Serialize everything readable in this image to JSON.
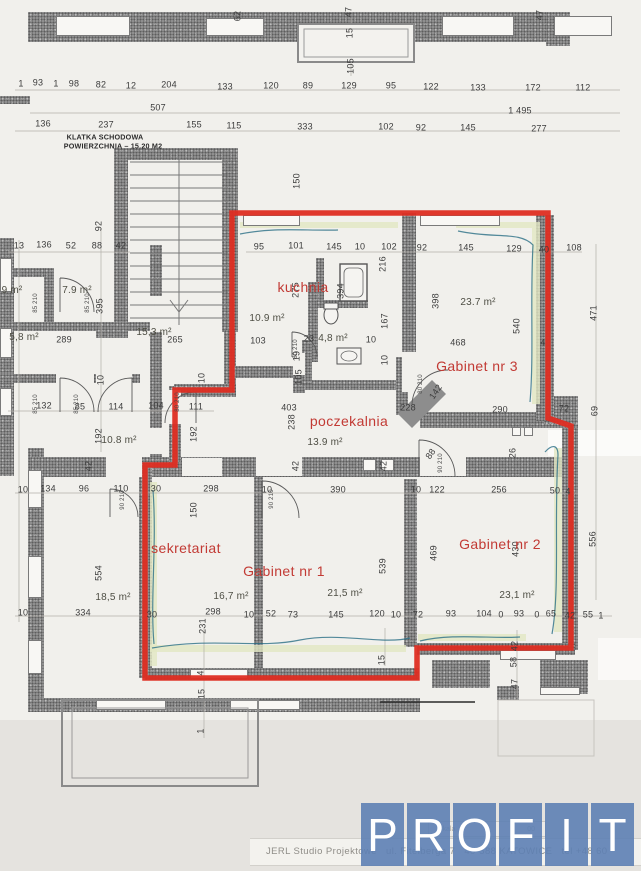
{
  "stairwell_note": {
    "line1": "KLATKA SCHODOWA",
    "line2": "POWIERZCHNIA – 15.20 M2"
  },
  "rooms": [
    {
      "label": "kuchnia",
      "x": 303,
      "y": 287,
      "area": "10.9 m²",
      "ax": 267,
      "ay": 319
    },
    {
      "label": "Gabinet nr 3",
      "x": 477,
      "y": 366,
      "area": "23.7 m²",
      "ax": 478,
      "ay": 303
    },
    {
      "label": "poczekalnia",
      "x": 349,
      "y": 421,
      "area": "13.9 m²",
      "ax": 325,
      "ay": 443
    },
    {
      "label": "sekretariat",
      "x": 186,
      "y": 548,
      "area": "16,7 m²",
      "ax": 231,
      "ay": 597
    },
    {
      "label": "Gabinet nr 1",
      "x": 284,
      "y": 571,
      "area": "21,5 m²",
      "ax": 345,
      "ay": 594
    },
    {
      "label": "Gabinet nr 2",
      "x": 500,
      "y": 544,
      "area": "23,1 m²",
      "ax": 517,
      "ay": 596
    },
    {
      "label": "",
      "x": 0,
      "y": 0,
      "area": "4,8 m²",
      "ax": 333,
      "ay": 339
    }
  ],
  "outside_areas": [
    {
      "area": "9 m²",
      "x": 12,
      "y": 291
    },
    {
      "area": "7.9 m²",
      "x": 77,
      "y": 291
    },
    {
      "area": "5,8 m²",
      "x": 24,
      "y": 338
    },
    {
      "area": "15,3 m²",
      "x": 154,
      "y": 333
    },
    {
      "area": "10.8 m²",
      "x": 119,
      "y": 441
    },
    {
      "area": "18,5 m²",
      "x": 113,
      "y": 598
    }
  ],
  "dimensions": [
    {
      "t": "62",
      "x": 238,
      "y": 16,
      "o": "v"
    },
    {
      "t": "47",
      "x": 349,
      "y": 12,
      "o": "v"
    },
    {
      "t": "15",
      "x": 350,
      "y": 33,
      "o": "v"
    },
    {
      "t": "105",
      "x": 351,
      "y": 66,
      "o": "v"
    },
    {
      "t": "47",
      "x": 540,
      "y": 15,
      "o": "v"
    },
    {
      "t": "1",
      "x": 21,
      "y": 84
    },
    {
      "t": "93",
      "x": 38,
      "y": 83
    },
    {
      "t": "1",
      "x": 56,
      "y": 84
    },
    {
      "t": "98",
      "x": 74,
      "y": 84
    },
    {
      "t": "82",
      "x": 101,
      "y": 85
    },
    {
      "t": "12",
      "x": 131,
      "y": 86
    },
    {
      "t": "204",
      "x": 169,
      "y": 85
    },
    {
      "t": "133",
      "x": 225,
      "y": 87
    },
    {
      "t": "120",
      "x": 271,
      "y": 86
    },
    {
      "t": "89",
      "x": 308,
      "y": 86
    },
    {
      "t": "129",
      "x": 349,
      "y": 86
    },
    {
      "t": "95",
      "x": 391,
      "y": 86
    },
    {
      "t": "122",
      "x": 431,
      "y": 87
    },
    {
      "t": "133",
      "x": 478,
      "y": 88
    },
    {
      "t": "172",
      "x": 533,
      "y": 88
    },
    {
      "t": "112",
      "x": 583,
      "y": 88
    },
    {
      "t": "507",
      "x": 158,
      "y": 108
    },
    {
      "t": "1 495",
      "x": 520,
      "y": 111
    },
    {
      "t": "136",
      "x": 43,
      "y": 124
    },
    {
      "t": "237",
      "x": 106,
      "y": 125
    },
    {
      "t": "155",
      "x": 194,
      "y": 125
    },
    {
      "t": "115",
      "x": 234,
      "y": 126
    },
    {
      "t": "333",
      "x": 305,
      "y": 127
    },
    {
      "t": "102",
      "x": 386,
      "y": 127
    },
    {
      "t": "92",
      "x": 421,
      "y": 128
    },
    {
      "t": "145",
      "x": 468,
      "y": 128
    },
    {
      "t": "277",
      "x": 539,
      "y": 129
    },
    {
      "t": "150",
      "x": 297,
      "y": 181,
      "o": "v"
    },
    {
      "t": "92",
      "x": 99,
      "y": 226,
      "o": "v"
    },
    {
      "t": "13",
      "x": 19,
      "y": 246
    },
    {
      "t": "136",
      "x": 44,
      "y": 245
    },
    {
      "t": "52",
      "x": 71,
      "y": 246
    },
    {
      "t": "88",
      "x": 97,
      "y": 246
    },
    {
      "t": "42",
      "x": 121,
      "y": 246
    },
    {
      "t": "395",
      "x": 100,
      "y": 306,
      "o": "v"
    },
    {
      "t": "289",
      "x": 64,
      "y": 340
    },
    {
      "t": "265",
      "x": 175,
      "y": 340
    },
    {
      "t": "10",
      "x": 101,
      "y": 380,
      "o": "v"
    },
    {
      "t": "10",
      "x": 202,
      "y": 378,
      "o": "v"
    },
    {
      "t": "132",
      "x": 44,
      "y": 406
    },
    {
      "t": "85",
      "x": 80,
      "y": 407
    },
    {
      "t": "114",
      "x": 116,
      "y": 407
    },
    {
      "t": "104",
      "x": 156,
      "y": 406
    },
    {
      "t": "111",
      "x": 196,
      "y": 407
    },
    {
      "t": "192",
      "x": 99,
      "y": 436,
      "o": "v"
    },
    {
      "t": "192",
      "x": 194,
      "y": 434,
      "o": "v"
    },
    {
      "t": "42",
      "x": 89,
      "y": 466,
      "o": "v"
    },
    {
      "t": "42",
      "x": 296,
      "y": 466,
      "o": "v"
    },
    {
      "t": "42",
      "x": 384,
      "y": 466,
      "o": "v"
    },
    {
      "t": "403",
      "x": 289,
      "y": 408
    },
    {
      "t": "238",
      "x": 292,
      "y": 422,
      "o": "v"
    },
    {
      "t": "228",
      "x": 408,
      "y": 408
    },
    {
      "t": "142",
      "x": 436,
      "y": 392,
      "o": "d"
    },
    {
      "t": "88",
      "x": 431,
      "y": 454,
      "o": "d"
    },
    {
      "t": "95",
      "x": 259,
      "y": 247
    },
    {
      "t": "101",
      "x": 296,
      "y": 246
    },
    {
      "t": "145",
      "x": 334,
      "y": 247
    },
    {
      "t": "10",
      "x": 360,
      "y": 247
    },
    {
      "t": "102",
      "x": 389,
      "y": 247
    },
    {
      "t": "92",
      "x": 422,
      "y": 248
    },
    {
      "t": "145",
      "x": 466,
      "y": 248
    },
    {
      "t": "129",
      "x": 514,
      "y": 249
    },
    {
      "t": "40",
      "x": 544,
      "y": 250
    },
    {
      "t": "108",
      "x": 574,
      "y": 248
    },
    {
      "t": "275",
      "x": 296,
      "y": 290,
      "o": "v"
    },
    {
      "t": "394",
      "x": 341,
      "y": 291,
      "o": "v"
    },
    {
      "t": "216",
      "x": 383,
      "y": 264,
      "o": "v"
    },
    {
      "t": "103",
      "x": 258,
      "y": 341
    },
    {
      "t": "23",
      "x": 309,
      "y": 339
    },
    {
      "t": "10",
      "x": 371,
      "y": 340
    },
    {
      "t": "167",
      "x": 385,
      "y": 321,
      "o": "v"
    },
    {
      "t": "10",
      "x": 385,
      "y": 360,
      "o": "v"
    },
    {
      "t": "19",
      "x": 297,
      "y": 356,
      "o": "v"
    },
    {
      "t": "105",
      "x": 299,
      "y": 377,
      "o": "v"
    },
    {
      "t": "398",
      "x": 436,
      "y": 301,
      "o": "v"
    },
    {
      "t": "540",
      "x": 517,
      "y": 326,
      "o": "v"
    },
    {
      "t": "468",
      "x": 458,
      "y": 343
    },
    {
      "t": "4",
      "x": 543,
      "y": 343
    },
    {
      "t": "290",
      "x": 500,
      "y": 410
    },
    {
      "t": "72",
      "x": 564,
      "y": 409
    },
    {
      "t": "69",
      "x": 595,
      "y": 411,
      "o": "v"
    },
    {
      "t": "471",
      "x": 594,
      "y": 313,
      "o": "v"
    },
    {
      "t": "10",
      "x": 23,
      "y": 490
    },
    {
      "t": "134",
      "x": 48,
      "y": 489
    },
    {
      "t": "96",
      "x": 84,
      "y": 489
    },
    {
      "t": "110",
      "x": 121,
      "y": 489
    },
    {
      "t": "30",
      "x": 156,
      "y": 489
    },
    {
      "t": "298",
      "x": 211,
      "y": 489
    },
    {
      "t": "10",
      "x": 267,
      "y": 490
    },
    {
      "t": "390",
      "x": 338,
      "y": 490
    },
    {
      "t": "10",
      "x": 416,
      "y": 490
    },
    {
      "t": "122",
      "x": 437,
      "y": 490
    },
    {
      "t": "256",
      "x": 499,
      "y": 490
    },
    {
      "t": "50",
      "x": 555,
      "y": 491
    },
    {
      "t": "4",
      "x": 568,
      "y": 492
    },
    {
      "t": "150",
      "x": 194,
      "y": 510,
      "o": "v"
    },
    {
      "t": "539",
      "x": 383,
      "y": 566,
      "o": "v"
    },
    {
      "t": "556",
      "x": 593,
      "y": 539,
      "o": "v"
    },
    {
      "t": "469",
      "x": 434,
      "y": 553,
      "o": "v"
    },
    {
      "t": "430",
      "x": 516,
      "y": 549,
      "o": "v"
    },
    {
      "t": "26",
      "x": 513,
      "y": 453,
      "o": "v"
    },
    {
      "t": "554",
      "x": 99,
      "y": 573,
      "o": "v"
    },
    {
      "t": "10",
      "x": 23,
      "y": 613
    },
    {
      "t": "334",
      "x": 83,
      "y": 613
    },
    {
      "t": "30",
      "x": 152,
      "y": 615
    },
    {
      "t": "298",
      "x": 213,
      "y": 612
    },
    {
      "t": "231",
      "x": 203,
      "y": 626,
      "o": "v"
    },
    {
      "t": "10",
      "x": 249,
      "y": 615
    },
    {
      "t": "52",
      "x": 271,
      "y": 614
    },
    {
      "t": "73",
      "x": 293,
      "y": 615
    },
    {
      "t": "145",
      "x": 336,
      "y": 615
    },
    {
      "t": "120",
      "x": 377,
      "y": 614
    },
    {
      "t": "10",
      "x": 396,
      "y": 615
    },
    {
      "t": "72",
      "x": 418,
      "y": 615
    },
    {
      "t": "93",
      "x": 451,
      "y": 614
    },
    {
      "t": "104",
      "x": 484,
      "y": 614
    },
    {
      "t": "0",
      "x": 501,
      "y": 615
    },
    {
      "t": "93",
      "x": 519,
      "y": 614
    },
    {
      "t": "0",
      "x": 537,
      "y": 615
    },
    {
      "t": "65",
      "x": 551,
      "y": 614
    },
    {
      "t": "42",
      "x": 570,
      "y": 616
    },
    {
      "t": "55",
      "x": 588,
      "y": 615
    },
    {
      "t": "1",
      "x": 601,
      "y": 616
    },
    {
      "t": "15",
      "x": 382,
      "y": 660,
      "o": "v"
    },
    {
      "t": "4",
      "x": 201,
      "y": 673,
      "o": "v"
    },
    {
      "t": "15",
      "x": 202,
      "y": 694,
      "o": "v"
    },
    {
      "t": "1",
      "x": 201,
      "y": 731,
      "o": "v"
    },
    {
      "t": "42",
      "x": 515,
      "y": 646,
      "o": "v"
    },
    {
      "t": "58",
      "x": 514,
      "y": 662,
      "o": "v"
    },
    {
      "t": "47",
      "x": 515,
      "y": 684,
      "o": "v"
    }
  ],
  "door_labels": [
    {
      "t": "85 210",
      "x": 36,
      "y": 303
    },
    {
      "t": "85 210",
      "x": 88,
      "y": 303
    },
    {
      "t": "85 210",
      "x": 36,
      "y": 404
    },
    {
      "t": "85 210",
      "x": 77,
      "y": 404
    },
    {
      "t": "90 210",
      "x": 123,
      "y": 500
    },
    {
      "t": "80 210",
      "x": 178,
      "y": 402
    },
    {
      "t": "90 210",
      "x": 272,
      "y": 499
    },
    {
      "t": "80 210",
      "x": 296,
      "y": 349
    },
    {
      "t": "80 210",
      "x": 421,
      "y": 384
    },
    {
      "t": "90 210",
      "x": 441,
      "y": 463
    }
  ],
  "footer": {
    "studio": "JERL Studio Projektowe   ul. Fitelberga 7   40-588 KATOWICE   tel +48 60",
    "scale_word": "skala",
    "scale_digits": "00"
  },
  "logo": {
    "letters": [
      "P",
      "R",
      "O",
      "F",
      "I",
      "T"
    ],
    "tile_color": "#5d80b4",
    "letter_color": "#ffffff"
  },
  "colors": {
    "outline": "#de2d22",
    "room_label": "#c23a34"
  }
}
